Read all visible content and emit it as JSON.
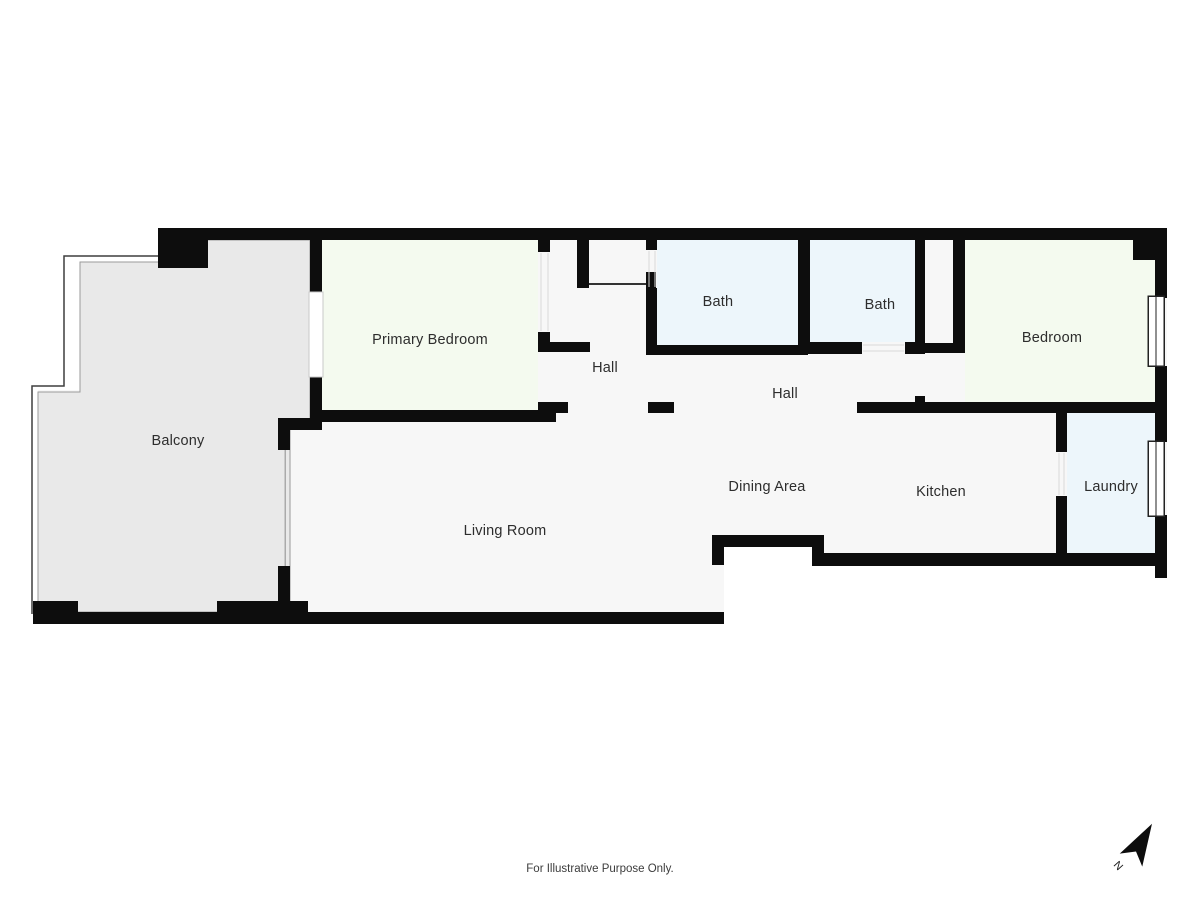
{
  "plan": {
    "footer_note": "For Illustrative Purpose Only.",
    "compass": {
      "label": "N"
    },
    "colors": {
      "wall": "#0d0d0d",
      "floor": "#f7f7f7",
      "balcony_floor": "#e9e9e9",
      "bedroom_fill": "#f4faef",
      "bath_fill": "#edf6fb",
      "background": "#ffffff",
      "label_text": "#2d2d2d"
    },
    "rooms": [
      {
        "label": "Balcony"
      },
      {
        "label": "Primary Bedroom"
      },
      {
        "label": "Hall"
      },
      {
        "label": "Bath"
      },
      {
        "label": "Bath"
      },
      {
        "label": "Bedroom"
      },
      {
        "label": "Hall"
      },
      {
        "label": "Dining Area"
      },
      {
        "label": "Kitchen"
      },
      {
        "label": "Laundry"
      },
      {
        "label": "Living Room"
      }
    ]
  }
}
